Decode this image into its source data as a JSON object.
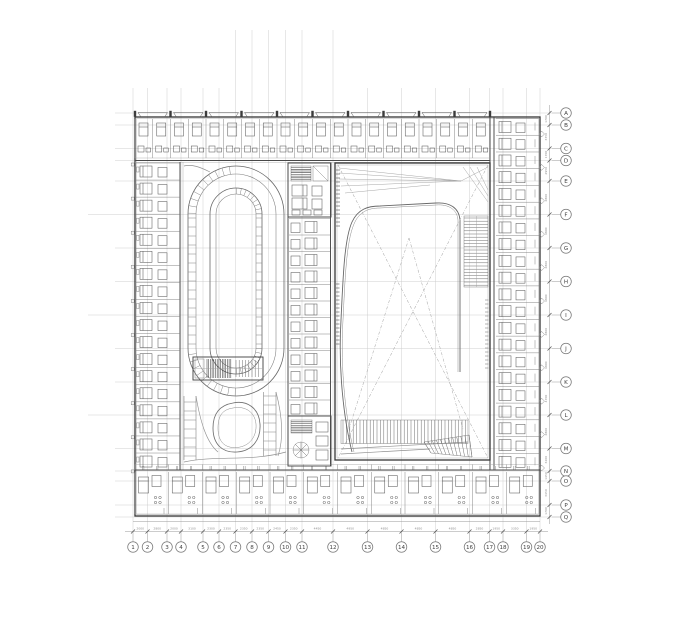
{
  "grid": {
    "cols": [
      "1",
      "2",
      "3",
      "4",
      "5",
      "6",
      "7",
      "8",
      "9",
      "10",
      "11",
      "12",
      "13",
      "14",
      "15",
      "16",
      "17",
      "18",
      "19",
      "20"
    ],
    "rows": [
      "A",
      "B",
      "C",
      "D",
      "E",
      "F",
      "G",
      "H",
      "I",
      "J",
      "K",
      "L",
      "M",
      "N",
      "O",
      "P",
      "Q"
    ]
  },
  "dimensions": {
    "bottom": [
      "2000",
      "2800",
      "2000",
      "3100",
      "2300",
      "2350",
      "2350",
      "2350",
      "2450",
      "2350",
      "4450",
      "4950",
      "4850",
      "4850",
      "4850",
      "2850",
      "1950",
      "3350",
      "1950"
    ],
    "right": [
      "1700",
      "3350",
      "1700",
      "2950",
      "4800",
      "4800",
      "4800",
      "4800",
      "4800",
      "4800",
      "4700",
      "4800",
      "3200",
      "1450",
      "3450",
      "1700"
    ]
  },
  "plan": {
    "room_counts": {
      "top_band": 20,
      "left_band": 18,
      "right_band": 21,
      "middle_band": 12,
      "bottom_band": 12
    },
    "features": [
      "racetrack-ramp",
      "courtyard-pond",
      "main-hall",
      "grand-stair",
      "side-stair",
      "stair-cores"
    ]
  },
  "colors": {
    "background": "#ffffff",
    "wall_dark": "#3c3c3c",
    "line_mid": "#6d6d6d",
    "grid_light": "#c9c9c9",
    "dim_text": "#8d8d8d"
  }
}
